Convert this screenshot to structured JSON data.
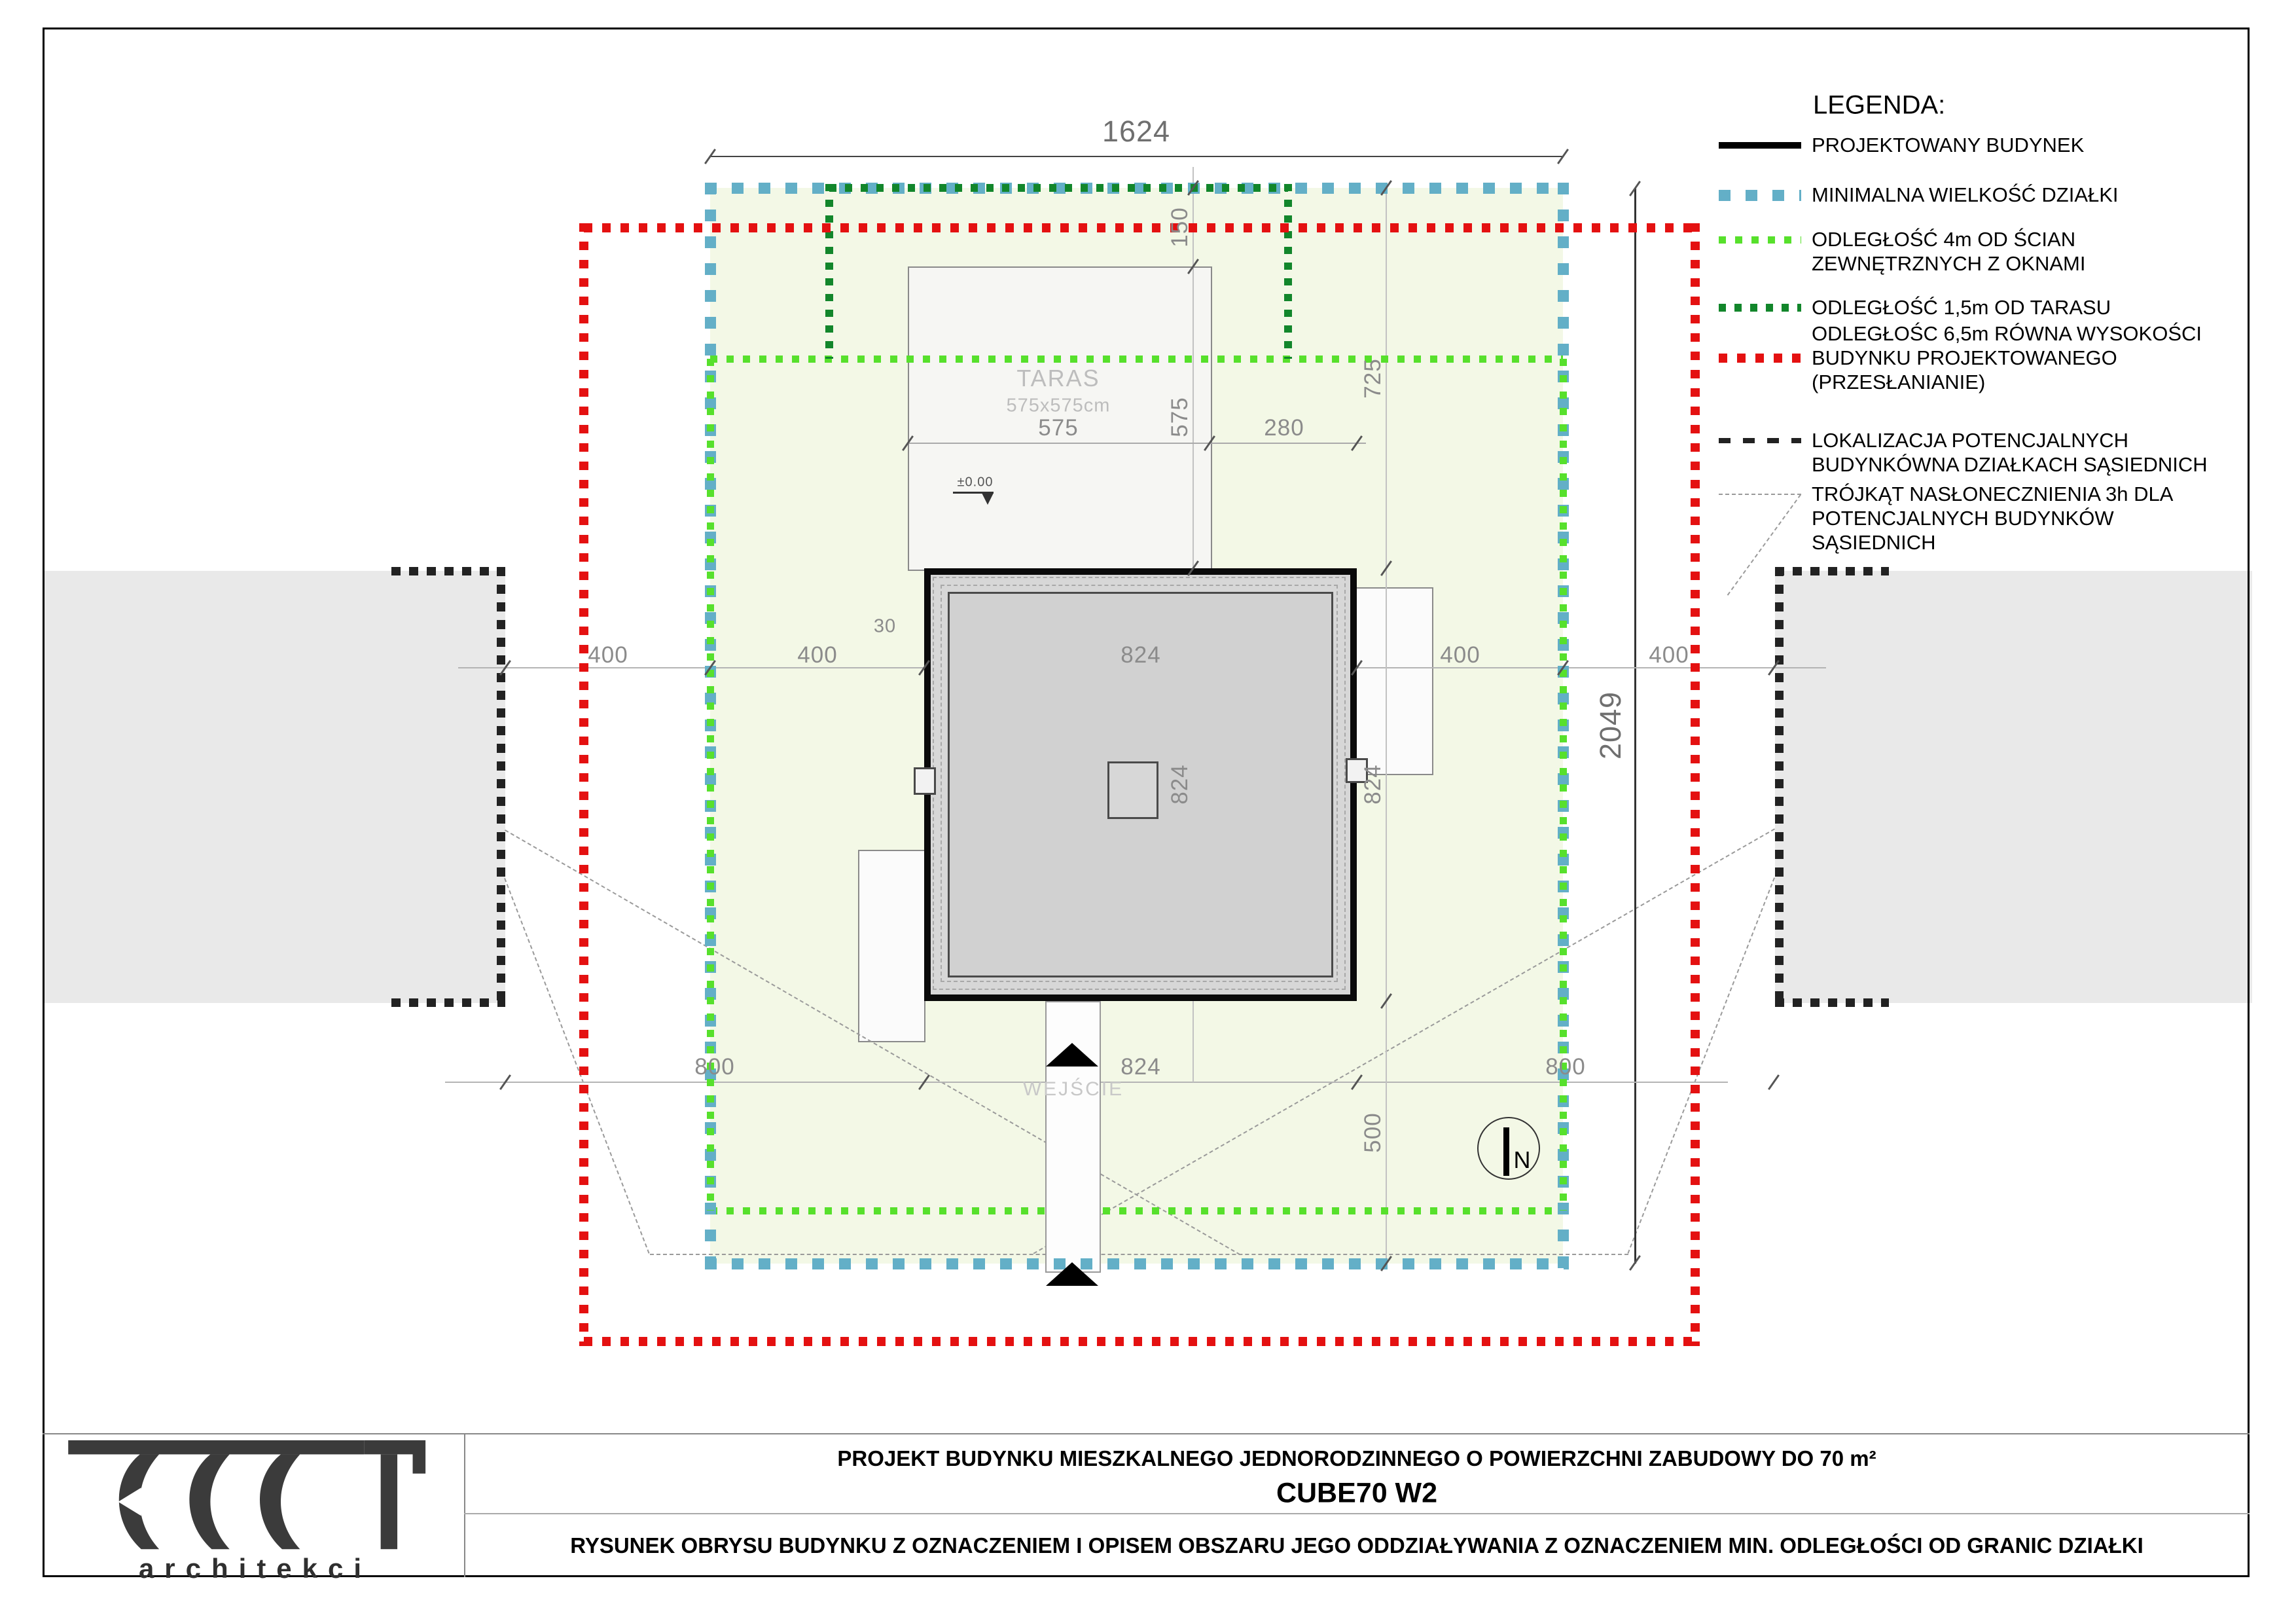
{
  "legend": {
    "title": "LEGENDA:",
    "items": [
      {
        "key": "projected-building",
        "lines": [
          "PROJEKTOWANY BUDYNEK"
        ]
      },
      {
        "key": "min-plot-size",
        "lines": [
          "MINIMALNA WIELKOŚĆ DZIAŁKI"
        ]
      },
      {
        "key": "setback-4m-walls",
        "lines": [
          "ODLEGŁOŚĆ 4m OD ŚCIAN",
          "ZEWNĘTRZNYCH Z OKNAMI"
        ]
      },
      {
        "key": "setback-terrace",
        "lines": [
          "ODLEGŁOŚĆ 1,5m OD TARASU"
        ]
      },
      {
        "key": "shading-distance",
        "lines": [
          "ODLEGŁOŚC 6,5m RÓWNA WYSOKOŚCI",
          "BUDYNKU PROJEKTOWANEGO",
          "(PRZESŁANIANIE)"
        ]
      },
      {
        "key": "neighbor-buildings",
        "lines": [
          "LOKALIZACJA POTENCJALNYCH",
          "BUDYNKÓWNA DZIAŁKACH SĄSIEDNICH"
        ]
      },
      {
        "key": "sun-triangle",
        "lines": [
          "TRÓJKĄT NASŁONECZNIENIA 3h DLA",
          "POTENCJALNYCH BUDYNKÓW",
          "SĄSIEDNICH"
        ]
      }
    ]
  },
  "dims": {
    "plot_width": "1624",
    "plot_height": "2049",
    "setback": "400",
    "neighbor_gap": "800",
    "building": "824",
    "top_to_building": "725",
    "terrace_side": "575",
    "below_building": "500",
    "terrace_to_corner": "280",
    "plot_to_terrace": "150",
    "roof_overhang": "30"
  },
  "labels": {
    "terrace_title": "TARAS",
    "terrace_size": "575x575cm",
    "entrance": "WEJŚCIE",
    "level": "±0.00",
    "north": "N"
  },
  "title_block": {
    "project_line": "PROJEKT BUDYNKU MIESZKALNEGO JEDNORODZINNEGO  O POWIERZCHNI ZABUDOWY DO 70 m²",
    "model": "CUBE70 W2",
    "drawing_line": "RYSUNEK OBRYSU BUDYNKU Z OZNACZENIEM I OPISEM OBSZARU JEGO ODDZIAŁYWANIA Z OZNACZENIEM MIN. ODLEGŁOŚCI OD GRANIC DZIAŁKI",
    "logo_text": "ROOT",
    "logo_sub": "architekci"
  },
  "colors": {
    "plot-fill": "#f3f8e6",
    "boundary-blue": "#63afc7",
    "setback-green": "#57e02c",
    "terrace-green": "#12862b",
    "shading-red": "#e41111",
    "neighbor-black": "#222222",
    "sun-gray": "#9a9a9a",
    "roof-fill": "#d7d7d7",
    "dim-text": "#8b8b8b"
  }
}
